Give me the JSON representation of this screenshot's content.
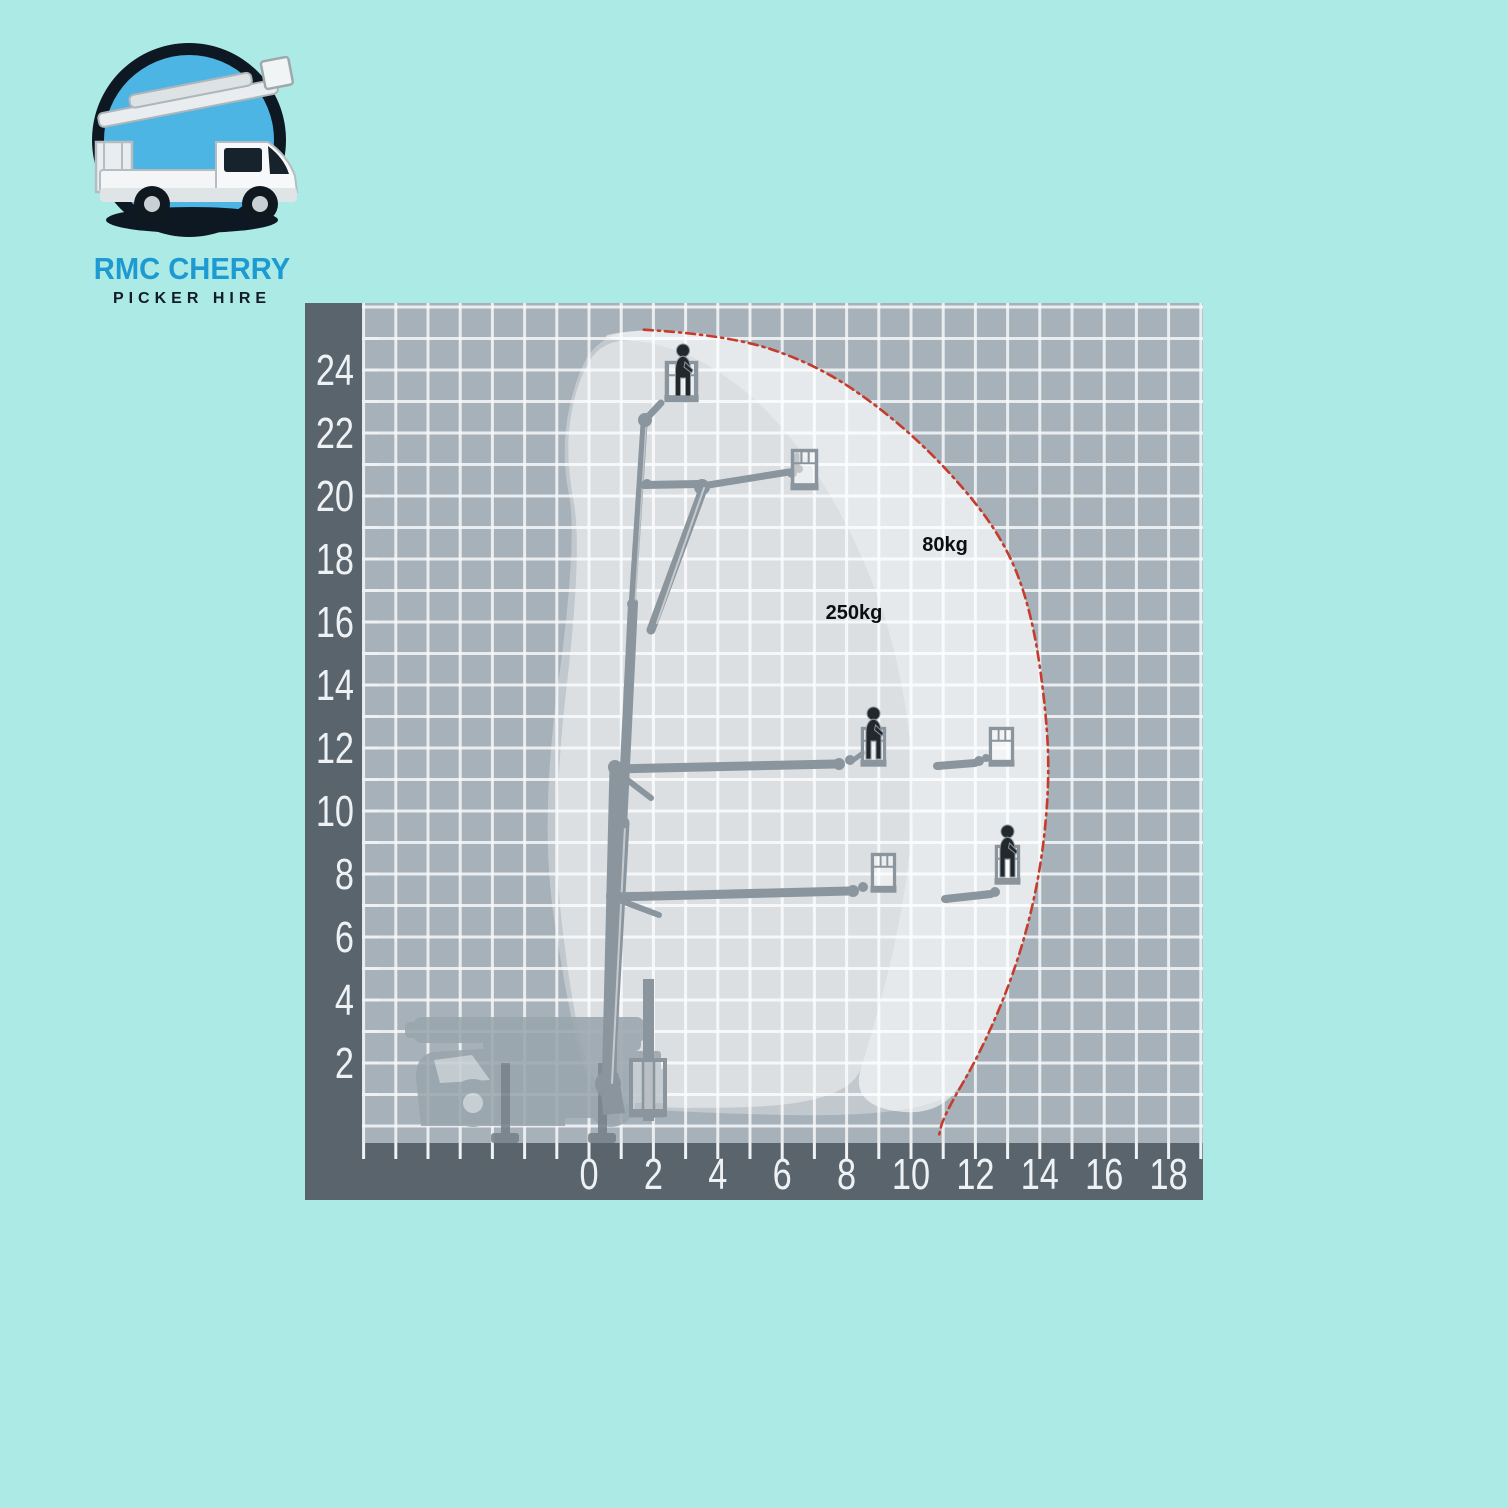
{
  "logo": {
    "title": "RMC CHERRY",
    "subtitle": "PICKER HIRE",
    "title_color": "#1e9ad2",
    "subtitle_color": "#131c25"
  },
  "colors": {
    "background": "#aceae5",
    "axis_band": "#59646c",
    "grid_background": "#a6b1b9",
    "grid_line": "#f6f8f9",
    "envelope_boundary_red": "#c63b2b",
    "machine_gray": "#8a959d",
    "axis_text": "#eef2f4",
    "kg_label_color": "#0b0e11"
  },
  "chart_data": {
    "type": "area",
    "title": "Cherry picker working envelope diagram (height vs outreach, metres)",
    "x_axis": {
      "tick_labels": [
        0,
        2,
        4,
        6,
        8,
        10,
        12,
        14,
        16,
        18
      ],
      "range_m": [
        -7,
        19
      ],
      "grid_step_m": 1
    },
    "y_axis": {
      "tick_labels": [
        2,
        4,
        6,
        8,
        10,
        12,
        14,
        16,
        18,
        20,
        22,
        24
      ],
      "range_m": [
        0,
        26
      ],
      "grid_step_m": 1
    },
    "zones": [
      {
        "label": "250kg",
        "label_pos_m": [
          7.35,
          16.1
        ],
        "outline_m": [
          [
            0.45,
            25.0
          ],
          [
            2.2,
            24.85
          ],
          [
            3.9,
            24.1
          ],
          [
            5.6,
            22.7
          ],
          [
            7.2,
            20.6
          ],
          [
            8.5,
            18.1
          ],
          [
            9.4,
            15.6
          ],
          [
            10.0,
            12.4
          ],
          [
            10.1,
            9.6
          ],
          [
            9.6,
            6.1
          ],
          [
            8.8,
            3.0
          ],
          [
            8.1,
            0.7
          ],
          [
            1.6,
            0.5
          ],
          [
            0.2,
            1.1
          ],
          [
            -0.5,
            3.5
          ],
          [
            -1.2,
            9.5
          ],
          [
            -0.2,
            18.3
          ],
          [
            -0.75,
            21.3
          ],
          [
            -0.4,
            23.6
          ]
        ]
      },
      {
        "label": "80kg",
        "label_pos_m": [
          10.35,
          18.25
        ],
        "outline_m": [
          [
            0.45,
            25.0
          ],
          [
            2.2,
            24.85
          ],
          [
            3.9,
            24.1
          ],
          [
            5.6,
            22.7
          ],
          [
            7.2,
            20.6
          ],
          [
            8.5,
            18.1
          ],
          [
            9.4,
            15.6
          ],
          [
            10.0,
            12.4
          ],
          [
            10.1,
            9.6
          ],
          [
            9.6,
            6.1
          ],
          [
            8.8,
            3.0
          ],
          [
            8.1,
            0.7
          ],
          [
            10.9,
            0.25
          ],
          [
            12.2,
            2.4
          ],
          [
            13.3,
            5.1
          ],
          [
            14.0,
            7.9
          ],
          [
            14.3,
            10.8
          ],
          [
            14.2,
            13.2
          ],
          [
            13.75,
            16.3
          ],
          [
            12.9,
            18.6
          ],
          [
            11.2,
            20.8
          ],
          [
            9.2,
            22.7
          ],
          [
            7.0,
            24.2
          ],
          [
            4.3,
            25.1
          ],
          [
            2.0,
            25.3
          ],
          [
            0.6,
            25.15
          ]
        ]
      }
    ],
    "envelope_outline_m": [
      [
        0.6,
        25.15
      ],
      [
        2.0,
        25.3
      ],
      [
        4.3,
        25.1
      ],
      [
        7.0,
        24.2
      ],
      [
        9.2,
        22.7
      ],
      [
        11.2,
        20.8
      ],
      [
        12.9,
        18.6
      ],
      [
        13.75,
        16.3
      ],
      [
        14.2,
        13.2
      ],
      [
        14.3,
        10.8
      ],
      [
        14.0,
        7.9
      ],
      [
        13.3,
        5.1
      ],
      [
        12.2,
        2.4
      ],
      [
        10.9,
        0.25
      ],
      [
        1.5,
        0.45
      ],
      [
        0.1,
        0.9
      ],
      [
        -0.6,
        3.4
      ],
      [
        -1.55,
        9.6
      ],
      [
        -0.35,
        18.6
      ],
      [
        -0.9,
        21.5
      ],
      [
        -0.3,
        24.2
      ]
    ],
    "boundary_dashdot_m": [
      [
        1.7,
        25.28
      ],
      [
        4.3,
        25.12
      ],
      [
        7.0,
        24.2
      ],
      [
        9.2,
        22.7
      ],
      [
        11.2,
        20.8
      ],
      [
        12.9,
        18.6
      ],
      [
        13.75,
        16.3
      ],
      [
        14.2,
        13.2
      ],
      [
        14.3,
        10.8
      ],
      [
        14.0,
        7.9
      ],
      [
        13.3,
        5.1
      ],
      [
        12.2,
        2.4
      ],
      [
        11.0,
        0.3
      ],
      [
        10.85,
        -0.4
      ]
    ]
  }
}
